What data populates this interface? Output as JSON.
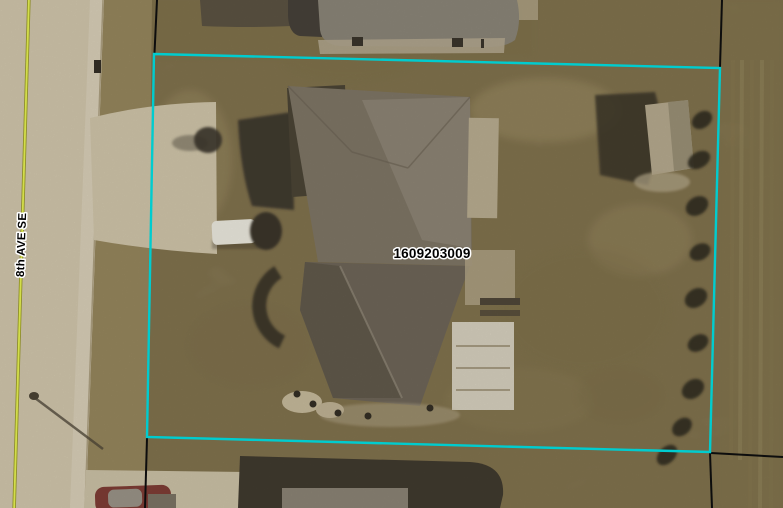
{
  "map": {
    "parcel": {
      "id_label": "1609203009"
    },
    "street": {
      "name": "8th AVE SE"
    },
    "colors": {
      "parcel_highlight": "#00cccf",
      "parcel_line": "#0d0d0d",
      "street_centerline": "#d2dd4a",
      "street_centerline_edge": "#8c8c28",
      "label_text": "#000000",
      "label_halo": "#ffffff"
    }
  }
}
